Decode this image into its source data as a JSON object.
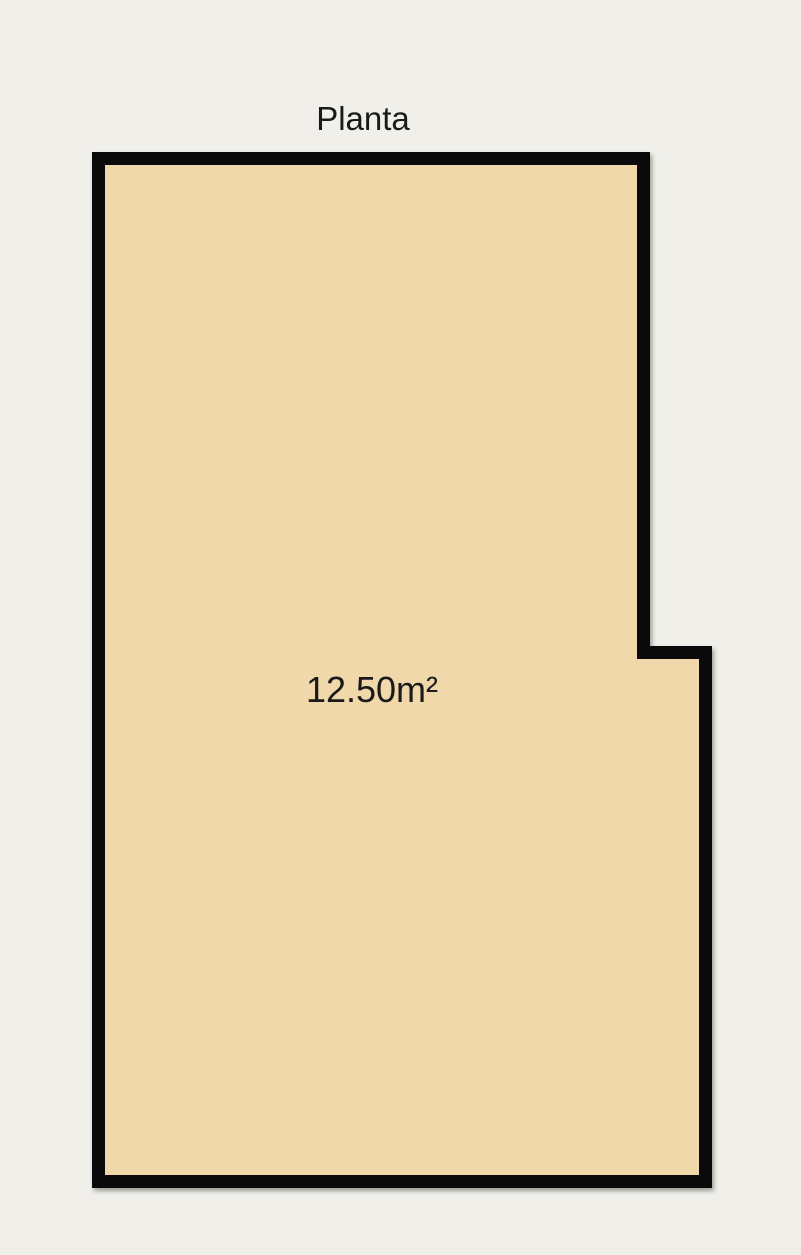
{
  "colors": {
    "background": "#f0efea",
    "room_fill": "#f0d8aa",
    "wall": "#0a0a0a",
    "text": "#1a1a1a"
  },
  "plan": {
    "title": "Planta",
    "room": {
      "area_label": "12.50m²",
      "wall_thickness": 13,
      "outline_points": "98.5,158.5 643.5,158.5 643.5,652.5 705.5,652.5 705.5,1181.5 98.5,1181.5"
    }
  }
}
